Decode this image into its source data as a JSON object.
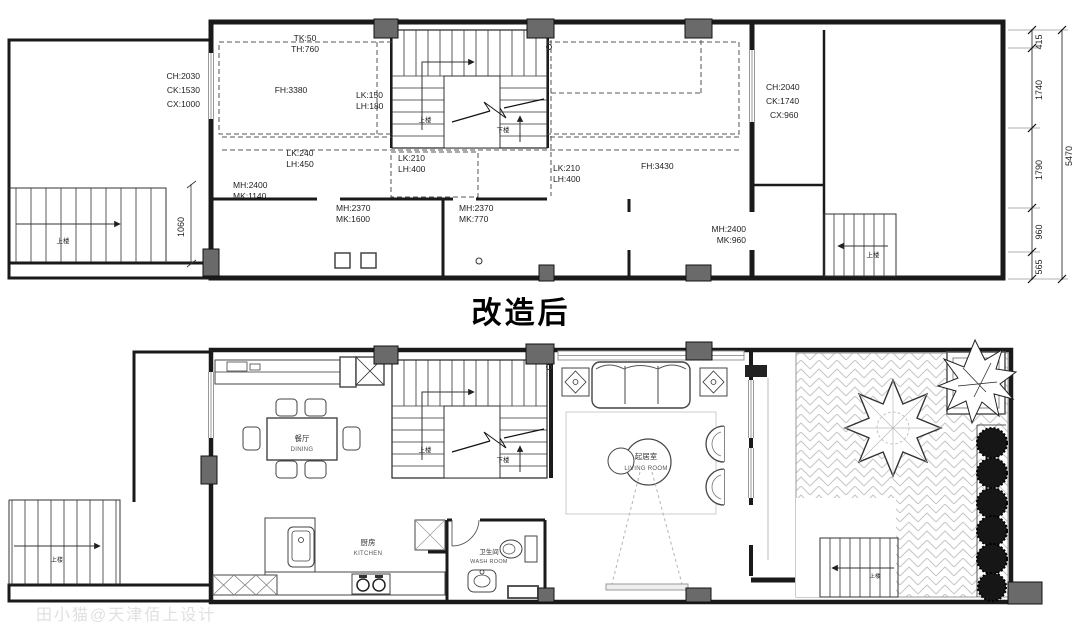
{
  "title": "改造后",
  "watermark": "田小猫@天津佰上设计",
  "stairs": {
    "up": "上楼",
    "down": "下楼"
  },
  "dimensions": {
    "right_chain": {
      "d1": "415",
      "d2": "1740",
      "d3": "1790",
      "d4": "960",
      "d5": "565"
    },
    "total": "5470",
    "left_stair": "1060"
  },
  "upper_plan": {
    "annotations": {
      "tk": "TK:50",
      "th": "TH:760",
      "fh_left": "FH:3380",
      "lk1a": "LK:150",
      "lk1b": "LH:180",
      "lk2a": "LK:240",
      "lk2b": "LH:450",
      "lk3a": "LK:210",
      "lk3b": "LH:400",
      "lk4a": "LK:210",
      "lk4b": "LH:400",
      "fh_right": "FH:3430",
      "mh1a": "MH:2400",
      "mh1b": "MK:1140",
      "mh2a": "MH:2370",
      "mh2b": "MK:1600",
      "mh3a": "MH:2370",
      "mh3b": "MK:770",
      "mh4a": "MH:2400",
      "mh4b": "MK:960",
      "chl1": "CH:2030",
      "chl2": "CK:1530",
      "chl3": "CX:1000",
      "chr1": "CH:2040",
      "chr2": "CK:1740",
      "chr3": "CX:960"
    }
  },
  "lower_plan": {
    "rooms": {
      "dining_zh": "餐厅",
      "dining_en": "DINING",
      "kitchen_zh": "厨房",
      "kitchen_en": "KITCHEN",
      "wash_zh": "卫生间",
      "wash_en": "WASH ROOM",
      "living_zh": "起居室",
      "living_en": "LIVING ROOM"
    }
  },
  "colors": {
    "wall": "#1a1a1a",
    "column_fill": "#6a6a6a",
    "dashed_line": "#555555",
    "window": "#999999",
    "furniture": "#444444",
    "paving": "#c6c6c6",
    "text": "#1f1f1f",
    "watermark": "#e0e0e0",
    "shrub": "#161616"
  }
}
